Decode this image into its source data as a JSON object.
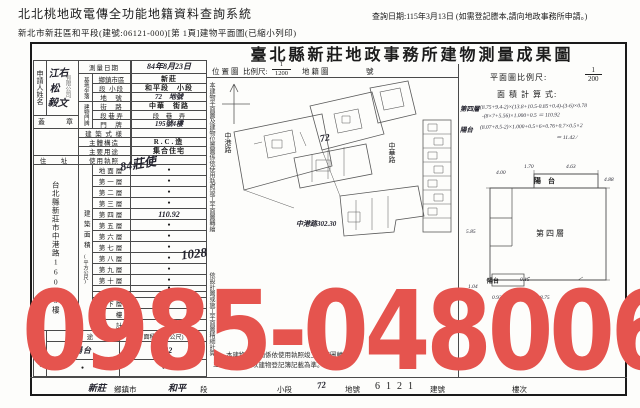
{
  "header": {
    "system_title": "北北桃地政電傳全功能地籍資料查詢系統",
    "subtitle": "新北市新莊區和平段(建號:06121-000)[第 1頁]建物平面圖(已縮小列印)",
    "query_date": "查詢日期:115年3月13日 (如需登記謄本,請向地政事務所申請。)"
  },
  "form": {
    "title": "臺北縣新莊地政事務所建物測量成果圖",
    "applicant": {
      "label": "申請人姓名",
      "name": "江右松",
      "name2": "毅文",
      "stamp": "有限公司",
      "seal_left": "蓋",
      "seal_right": "章"
    },
    "address": {
      "label": "住　址",
      "value": "台北縣新莊市中港路160號3樓"
    },
    "rows": {
      "survey": {
        "label": "測量日期",
        "value": "84年8月23日"
      },
      "site_label": "基地坐落",
      "district": {
        "label": "鄉鎮市區",
        "value": "新莊"
      },
      "section": {
        "label": "段 小段",
        "value": "和平段　小段"
      },
      "lot": {
        "label": "地　號",
        "value": "72　地號"
      },
      "door_label": "建物門牌",
      "street": {
        "label": "街　路",
        "value": "中華　街路"
      },
      "lane": {
        "label": "段 巷 弄",
        "value": "段　巷　弄"
      },
      "door": {
        "label": "門　牌",
        "value": "195號4樓"
      },
      "style": {
        "label": "建 築 式 樣",
        "value": ""
      },
      "structure": {
        "label": "主體構造",
        "value": "R.C.造"
      },
      "usage": {
        "label": "主要用途",
        "value": "集合住宅"
      },
      "license": {
        "label": "使用執照",
        "hand_a": "84莊使",
        "hand_b": "1028"
      }
    },
    "floor_area": {
      "label": "建築面積",
      "unit": "(平方公尺)",
      "rows": [
        {
          "label": "地面層",
          "value": "●"
        },
        {
          "label": "第一層",
          "value": "●"
        },
        {
          "label": "第二層",
          "value": "●"
        },
        {
          "label": "第三層",
          "value": "●"
        },
        {
          "label": "第四層",
          "value": "110.92"
        },
        {
          "label": "第五層",
          "value": "●"
        },
        {
          "label": "第六層",
          "value": "●"
        },
        {
          "label": "第七層",
          "value": "●"
        },
        {
          "label": "第八層",
          "value": "●"
        },
        {
          "label": "第九層",
          "value": "●"
        },
        {
          "label": "第十層",
          "value": "●"
        },
        {
          "label": "",
          "value": "●"
        },
        {
          "label": "",
          "value": "●"
        },
        {
          "label": "地下層",
          "value": "●"
        },
        {
          "label": "騎　樓",
          "value": ""
        },
        {
          "label": "合　計",
          "value": "●"
        }
      ]
    },
    "annex": {
      "label": "附屬建物",
      "col_use": "用　途",
      "col_area": "面積(平方公尺)",
      "rows": [
        {
          "use": "陽台",
          "area": "11.42"
        },
        {
          "use": "●",
          "area": "●"
        }
      ]
    },
    "notes_vertical": [
      "本建物平面圖及建物位置圖係依使用執照竣工平面圖轉繪",
      "依設計圖或施工平面圖精細計算"
    ],
    "notes_bottom": [
      "一、本建物平面圖係依使用執照竣工平面圖轉繪。",
      "二、本成果表以建物登記簿記載為準。"
    ],
    "location_map": {
      "label": "位置圖",
      "scale_label": "比例尺:",
      "num": "1",
      "den": "1200",
      "map_label": "地籍圖",
      "no": "號",
      "street_left": "中港路",
      "street_right": "中華路",
      "lot": "72",
      "street_bottom": "中港路302.30"
    },
    "plan": {
      "scale_label": "平面圖比例尺:",
      "num": "1",
      "den": "200",
      "calc_label": "面 積 計 算 式:",
      "calc": [
        {
          "name": "第四層",
          "l1": "(8.75+9.4-2)×(13.8+10.5-0.85+0.4)-(3-6)×0.78",
          "l2": "-(8×7+5.56)×1.000+0.5 ＝ 110.92"
        },
        {
          "name": "陽台",
          "l1": "(8.07+8.5-2)×1.000+0.5+6×0.76+0.7×0.5×2",
          "l2": "＝ 11.42 ∕"
        }
      ],
      "sketch": {
        "room": "第四層",
        "balcony_top": "陽　台",
        "balcony_bottom": "陽台",
        "dims": [
          "4.00",
          "1.70",
          "4.63",
          "4.88",
          "5.85",
          "0.15",
          "1.04",
          "0.93",
          "8.75"
        ]
      }
    },
    "bottom": {
      "v1": "新莊",
      "l1": "鄉鎮市",
      "v2": "和平",
      "l2": "段",
      "l3": "小段",
      "v3": "72",
      "l4": "地號",
      "v4": "6121",
      "l5": "建號",
      "l6": "樓次"
    }
  },
  "watermark": {
    "text": "0985-048006"
  }
}
